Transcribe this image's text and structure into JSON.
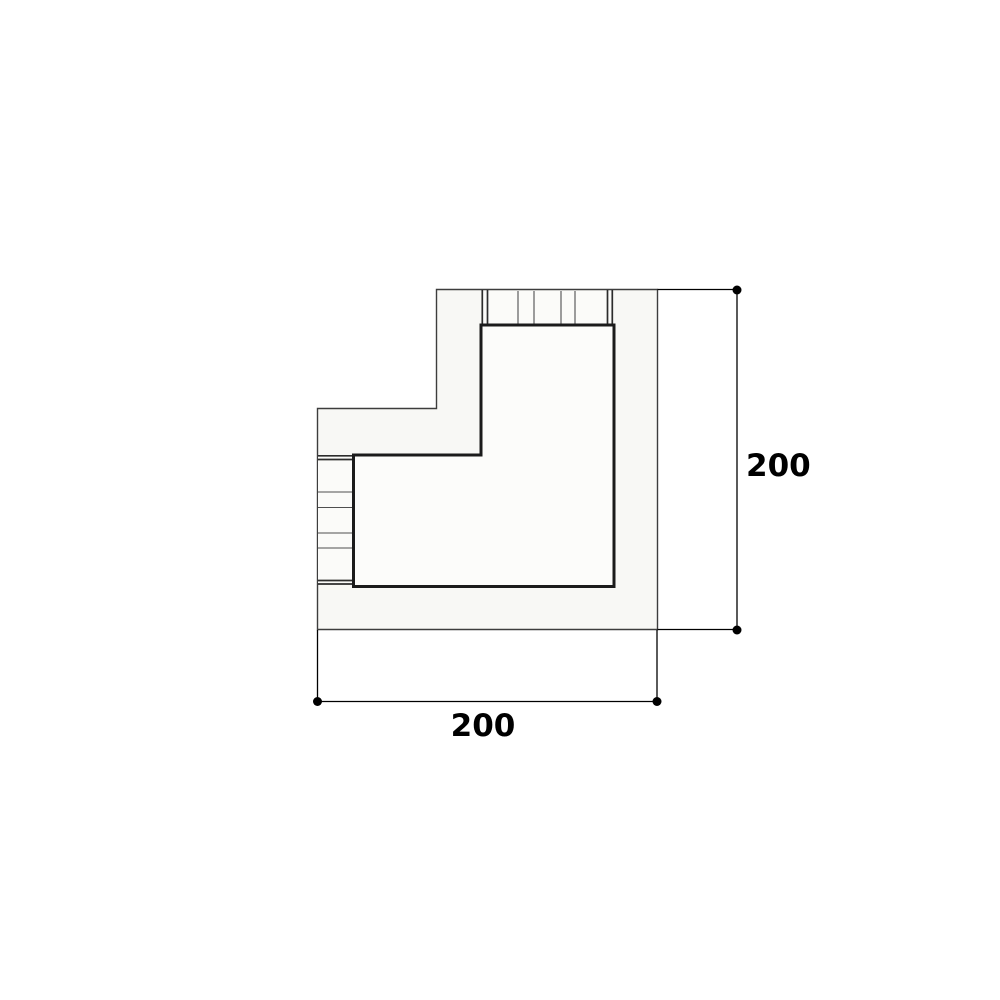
{
  "page": {
    "background": "#ffffff"
  },
  "drawing": {
    "name": "corner-module-plan",
    "type": "technical plan drawing",
    "description": "Top view plan of an L-shaped corner module with slatted backrest strips on the top and left outer edges, annotated with two dimension lines.",
    "colors": {
      "outline": "#3d3d3d",
      "seat_outline": "#1b1b1b",
      "slat_line": "#4f4f4f",
      "slat_edge": "#2c2c2c",
      "dimension_line": "#000000",
      "label_color": "#000000",
      "platform_fill": "#f8f8f5",
      "seat_fill": "#fcfcfa",
      "slat_fill": "#fbfbf9"
    }
  },
  "dimensions": {
    "vertical": {
      "label": "200",
      "side": "right"
    },
    "horizontal": {
      "label": "200",
      "side": "bottom"
    }
  }
}
